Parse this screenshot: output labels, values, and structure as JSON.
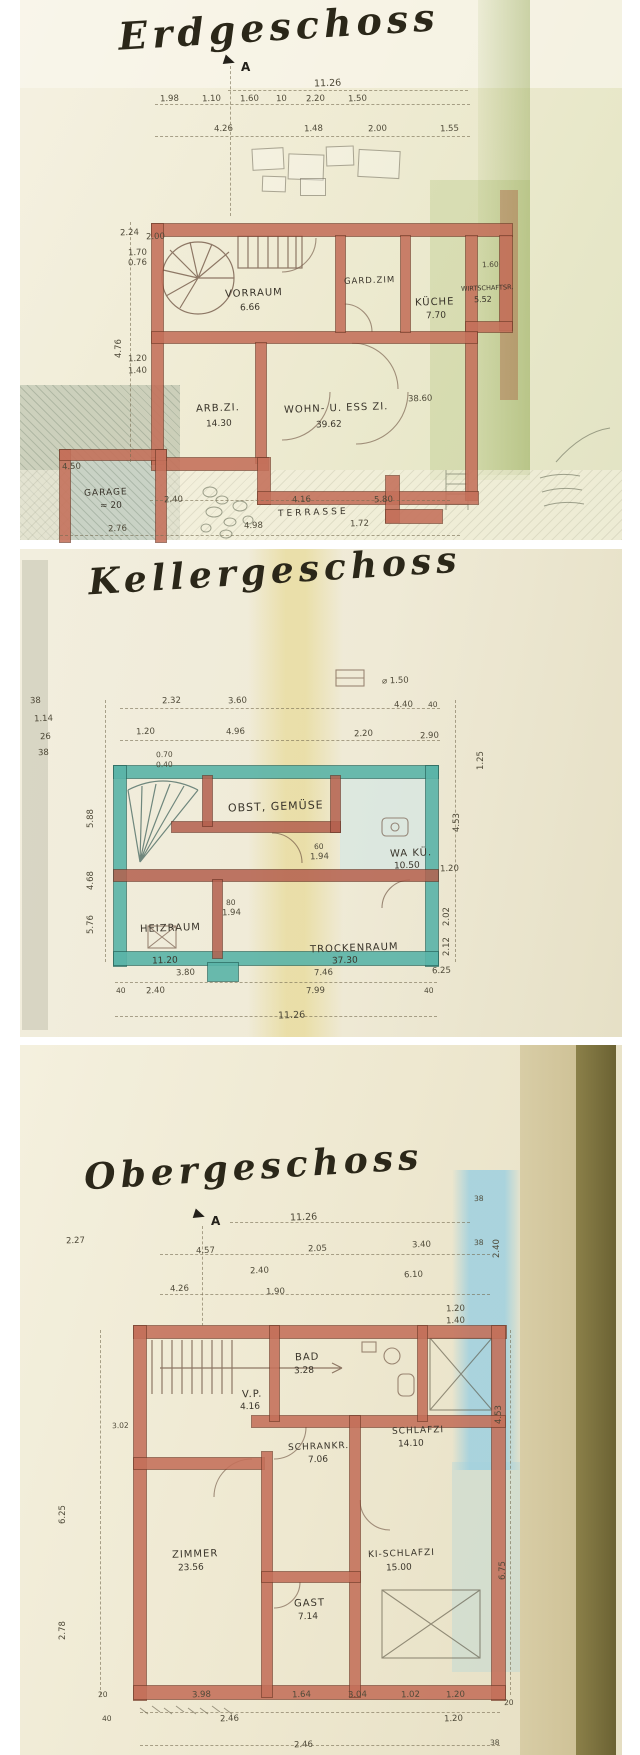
{
  "document": {
    "kind": "scanned hand-drawn architectural floor plans",
    "ink_color": "#46402e",
    "paper_color": "#efe9d4"
  },
  "panels": [
    {
      "title": "Erdgeschoss",
      "section_marker": "A",
      "overall_width": "11.26",
      "wall_color": "#c4705a",
      "rooms": [
        {
          "name": "VORRAUM",
          "area": "6.66"
        },
        {
          "name": "GARD.ZIM",
          "area": ""
        },
        {
          "name": "KÜCHE",
          "area": "7.70"
        },
        {
          "name": "WIRTSCHAFTSR.",
          "area": "5.52"
        },
        {
          "name": "ARB.ZI.",
          "area": "14.30"
        },
        {
          "name": "WOHN- U. ESS ZI.",
          "area": "39.62"
        },
        {
          "name": "GARAGE",
          "area": "≈ 20"
        },
        {
          "name": "TERRASSE",
          "area": ""
        }
      ],
      "dims_top1": [
        "1.98",
        "1.10",
        "1.60",
        "10",
        "2.20",
        "1.50"
      ],
      "dims_top2": [
        "4.26",
        "1.48",
        "2.00",
        "1.55"
      ],
      "dims_left": [
        "2.24",
        "2.00",
        "1.70",
        "0.76",
        "4.76",
        "1.20",
        "1.40"
      ],
      "dims_bottom1": [
        "2.40",
        "4.16",
        "5.80"
      ],
      "dims_bottom2": [
        "2.76",
        "4.98",
        "1.72"
      ],
      "dims_inner": [
        "1.60",
        "38.60",
        "4.50"
      ]
    },
    {
      "title": "Kellergeschoss",
      "wall_color": "#58b3a7",
      "rooms": [
        {
          "name": "OBST, GEMÜSE",
          "area": ""
        },
        {
          "name": "WA KÜ.",
          "area": "10.50"
        },
        {
          "name": "HEIZRAUM",
          "area": "11.20"
        },
        {
          "name": "TROCKENRAUM",
          "area": "37.30"
        }
      ],
      "dims_top1": [
        "2.32",
        "3.60",
        "4.40",
        "40"
      ],
      "dims_top2": [
        "1.20",
        "4.96",
        "2.20",
        "2.90"
      ],
      "dims_top3": [
        "0.70",
        "0.40",
        "⌀ 1.50"
      ],
      "dims_left": [
        "38",
        "1.14",
        "26",
        "38",
        "5.88",
        "4.68",
        "5.76"
      ],
      "dims_right": [
        "1.25",
        "4.53",
        "1.20",
        "2.02",
        "2.12"
      ],
      "dims_inner": [
        "60",
        "1.94",
        "80",
        "1.94"
      ],
      "dims_bottom1": [
        "3.80",
        "7.46",
        "6.25"
      ],
      "dims_bottom2": [
        "40",
        "2.40",
        "7.99",
        "40"
      ],
      "dims_bottom3": [
        "11.26"
      ]
    },
    {
      "title": "Obergeschoss",
      "section_marker": "A",
      "overall_width": "11.26",
      "wall_color": "#c4705a",
      "rooms": [
        {
          "name": "BAD",
          "area": "3.28"
        },
        {
          "name": "V.P.",
          "area": "4.16"
        },
        {
          "name": "SCHLAFZI",
          "area": "14.10"
        },
        {
          "name": "SCHRANKR.",
          "area": "7.06"
        },
        {
          "name": "ZIMMER",
          "area": "23.56"
        },
        {
          "name": "KI-SCHLAFZI",
          "area": "15.00"
        },
        {
          "name": "GAST",
          "area": "7.14"
        }
      ],
      "dims_top1": [
        "4.57",
        "2.05",
        "3.40",
        "38"
      ],
      "dims_top2": [
        "2.40",
        "6.10"
      ],
      "dims_top3": [
        "4.26",
        "1.90"
      ],
      "dims_left": [
        "2.27",
        "3.02",
        "6.25",
        "2.78",
        "20"
      ],
      "dims_right": [
        "38",
        "2.40",
        "1.20",
        "1.40",
        "4.53",
        "6.75",
        "20",
        "38"
      ],
      "dims_bottom1": [
        "3.98",
        "1.64",
        "3.04",
        "1.02",
        "1.20"
      ],
      "dims_bottom2": [
        "40",
        "2.46",
        "1.20"
      ],
      "dims_bottom3": [
        "2.46",
        "38"
      ]
    }
  ]
}
